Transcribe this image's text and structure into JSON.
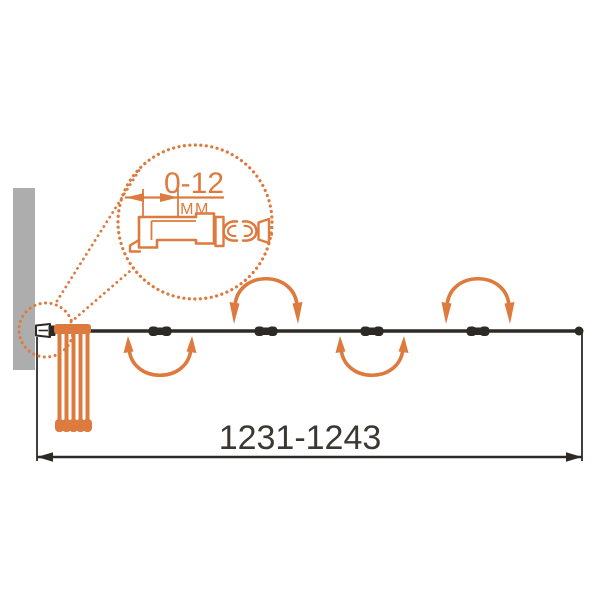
{
  "labels": {
    "width_range": "1231-1243",
    "detail_range": "0-12",
    "detail_unit": "ММ"
  },
  "colors": {
    "accent": "#DD7A3E",
    "wall": "#ADADAD",
    "dark": "#2D2A26",
    "text": "#3B3733",
    "background": "#FFFFFF"
  },
  "diagram": {
    "type": "folding-bath-screen-top-view",
    "folded_panel_bars": 5,
    "hinge_count": 4,
    "fold_direction_sequence": [
      "up",
      "down",
      "up",
      "down"
    ],
    "overall_width_label": "1231-1243",
    "wall_profile_adjustment_label": "0-12 ММ"
  }
}
